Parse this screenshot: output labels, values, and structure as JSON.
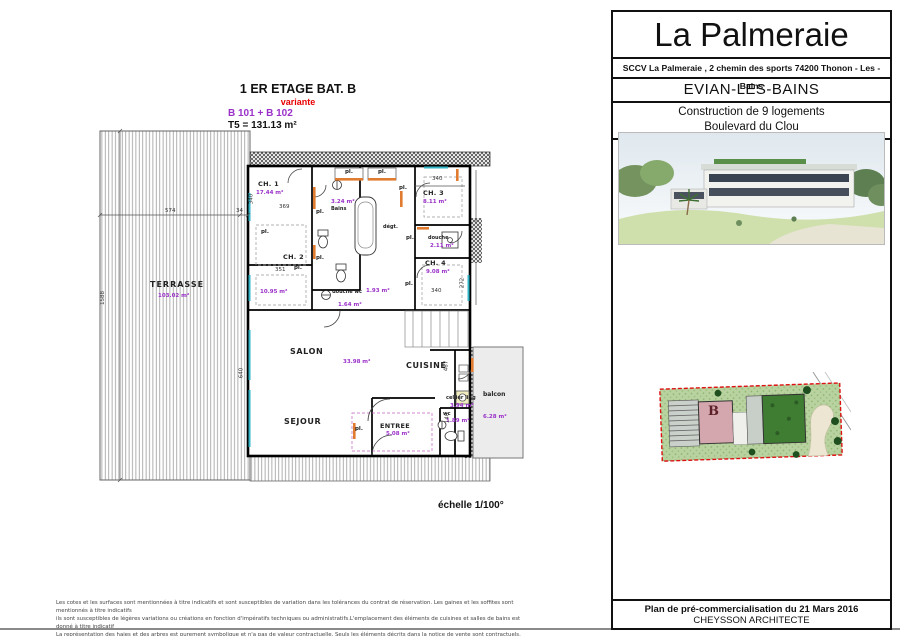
{
  "colors": {
    "accent_purple": "#9a30c8",
    "variant_red": "#e80000",
    "door_orange": "#e07b2f",
    "window_teal": "#35b6c8",
    "plot_red": "#dd1111"
  },
  "plan": {
    "title": "1 ER ETAGE BAT. B",
    "variant": "variante",
    "lots": "B 101 + B 102",
    "type_area": "T5 = 131.13 m²",
    "scale": "échelle 1/100°",
    "closet_label": "pl.",
    "rooms": {
      "terrasse": {
        "name": "TERRASSE",
        "area": "103.02 m²"
      },
      "ch1": {
        "name": "CH. 1",
        "area": "17.44 m²"
      },
      "ch2": {
        "name": "CH. 2",
        "area": "10.95 m²"
      },
      "bains": {
        "name": "Bains",
        "area": "3.24 m²"
      },
      "ch3": {
        "name": "CH. 3",
        "area": "8.11 m²"
      },
      "degagement": {
        "name": "dégt.",
        "area": "1.93 m²"
      },
      "douche": {
        "name": "douche",
        "area": "2.11 m²"
      },
      "ch4": {
        "name": "CH. 4",
        "area": "9.08 m²"
      },
      "douche_wc": {
        "name": "douche wc",
        "area": "1.64 m²"
      },
      "salon": {
        "name": "SALON"
      },
      "cuisine": {
        "name": "CUISINE"
      },
      "sejour": {
        "name": "SEJOUR",
        "area": "33.98 m²"
      },
      "entree": {
        "name": "ENTREE",
        "area": "5.08 m²"
      },
      "cellier": {
        "name": "cellier ling",
        "area": "3.94 m²"
      },
      "wc": {
        "name": "wc",
        "area": "1.89 m²"
      },
      "balcon": {
        "name": "balcon",
        "area": "6.28 m²"
      }
    },
    "dims": {
      "terrasse_w": "574",
      "terrasse_gap": "34",
      "terrasse_h": "1588",
      "ch1_w": "369",
      "ch1_h": "340",
      "ch3_w": "340",
      "ch2_w": "351",
      "ch4_w": "340",
      "salon_h": "640",
      "cuisine_h": "487",
      "ch4_h": "272",
      "wc_h": "140"
    }
  },
  "title_block": {
    "project": "La Palmeraie",
    "company_line": "SCCV La Palmeraie , 2 chemin des sports 74200 Thonon - Les - Bains",
    "city": "EVIAN-LES-BAINS",
    "program": "Construction de 9 logements",
    "street": "Boulevard du Clou",
    "footer_line1": "Plan de pré-commercialisation du 21 Mars 2016",
    "footer_line2": "CHEYSSON ARCHITECTE"
  },
  "site_plan": {
    "building_label": "B"
  },
  "disclaimer": {
    "line1": "Les cotes et les surfaces sont mentionnées à titre indicatifs et sont susceptibles de variation dans les tolérances du contrat de réservation. Les gaines et les soffites sont mentionnés à titre indicatifs",
    "line2": "ils sont susceptibles de légères variations ou créations en fonction d'impératifs techniques ou administratifs.L'emplacement des éléments de cuisines et salles de bains est donné à titre indicatif",
    "line3": "La représentation des haies et des arbres est purement symbolique et n'a pas de valeur contractuelle. Seuls les éléments décrits dans la notice de vente sont contractuels."
  }
}
